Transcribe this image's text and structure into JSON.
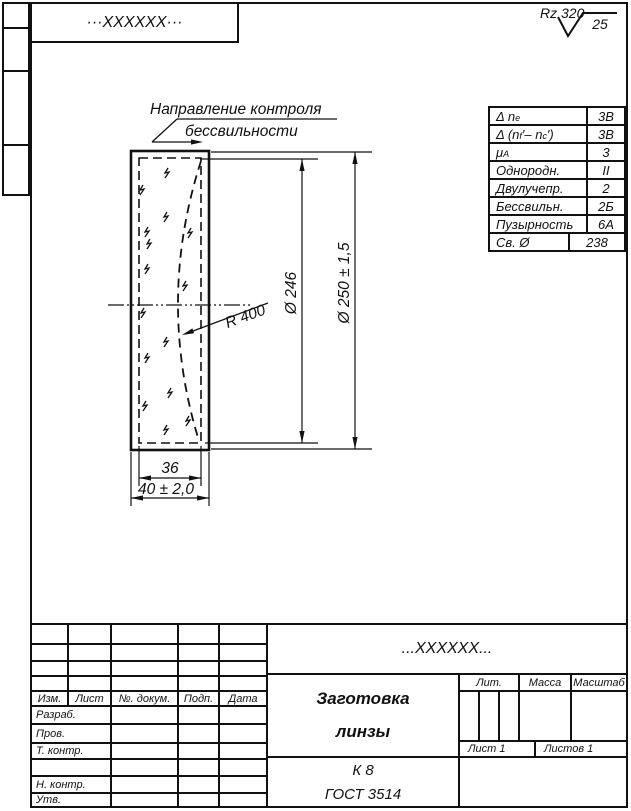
{
  "sheet": {
    "bg_color": "#ffffff",
    "line_color": "#111111"
  },
  "top_bar": {
    "designation": "···XXXXXX···"
  },
  "roughness": {
    "label": "Rz 320",
    "value": "25"
  },
  "spec_table": {
    "rows": [
      {
        "label_pre": "Δ n",
        "label_sub": "e",
        "value": "3В"
      },
      {
        "label_pre": "Δ (n",
        "label_sub": "f",
        "label_mid": "′– n",
        "label_sub2": "c",
        "label_post": "′)",
        "value": "3В"
      },
      {
        "label_pre": "μ",
        "label_sub": "A",
        "value": "3"
      },
      {
        "label": "Однородн.",
        "value": "II"
      },
      {
        "label": "Двулучепр.",
        "value": "2"
      },
      {
        "label": "Бессвильн.",
        "value": "2Б"
      },
      {
        "label": "Пузырность",
        "value": "6А"
      },
      {
        "label": "Св. Ø",
        "value": "238"
      }
    ]
  },
  "drawing": {
    "direction_label_line1": "Направление контроля",
    "direction_label_line2": "бессвильности",
    "radius_label": "R 400",
    "dim_inner_dia": "Ø 246",
    "dim_outer_dia": "Ø 250 ± 1,5",
    "dim_inner_width": "36",
    "dim_outer_width": "40 ± 2,0"
  },
  "title_block": {
    "designation": "...XXXXXX...",
    "doc_title_line1": "Заготовка",
    "doc_title_line2": "линзы",
    "material_line1": "К 8",
    "material_line2": "ГОСТ 3514",
    "header_cols": [
      "Изм.",
      "Лист",
      "№. докум.",
      "Подп.",
      "Дата"
    ],
    "row_labels": [
      "Разраб.",
      "Пров.",
      "Т. контр.",
      "",
      "Н. контр.",
      "Утв."
    ],
    "lit_label": "Лит.",
    "mass_label": "Масса",
    "scale_label": "Масштаб",
    "sheet_label": "Лист 1",
    "sheets_label": "Листов 1"
  }
}
